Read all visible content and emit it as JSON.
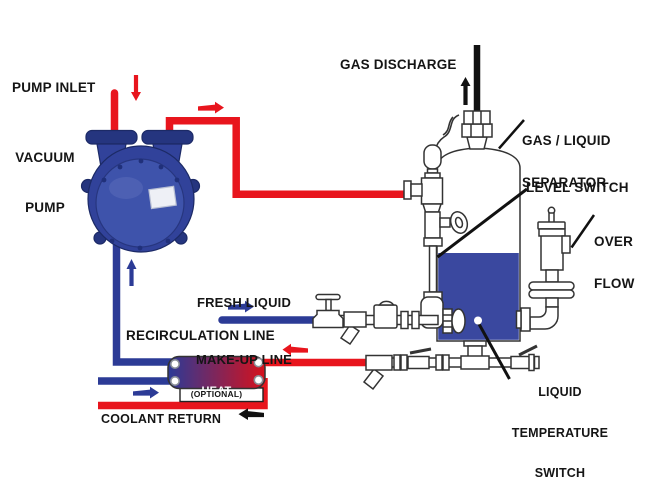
{
  "diagram": {
    "title_labels": {
      "pump_inlet": "PUMP INLET",
      "vacuum_pump_line1": "VACUUM",
      "vacuum_pump_line2": "PUMP",
      "gas_discharge": "GAS DISCHARGE",
      "separator_line1": "GAS / LIQUID",
      "separator_line2": "SEPARATOR",
      "level_switch": "LEVEL SWITCH",
      "overflow_line1": "OVER",
      "overflow_line2": "FLOW",
      "fresh_liquid_line1": "FRESH LIQUID",
      "fresh_liquid_line2": "MAKE-UP LINE",
      "recirculation": "RECIRCULATION LINE",
      "heat_exchanger_line1": "HEAT",
      "heat_exchanger_line2": "EXCHANGER",
      "heat_exchanger_note": "(OPTIONAL)",
      "coolant_return": "COOLANT RETURN",
      "temp_switch_line1": "LIQUID",
      "temp_switch_line2": "TEMPERATURE",
      "temp_switch_line3": "SWITCH"
    },
    "colors": {
      "hot_line": "#e8151d",
      "cool_line": "#2c3b96",
      "liquid_fill": "#3a489f",
      "pump_dark": "#25357f",
      "pump_mid": "#31429a",
      "pump_base": "#3e53ab",
      "hx_gradient_left": "#2b3a97",
      "hx_gradient_right": "#d6111c",
      "black_line": "#111111",
      "outline": "#333333",
      "background": "#ffffff"
    }
  }
}
